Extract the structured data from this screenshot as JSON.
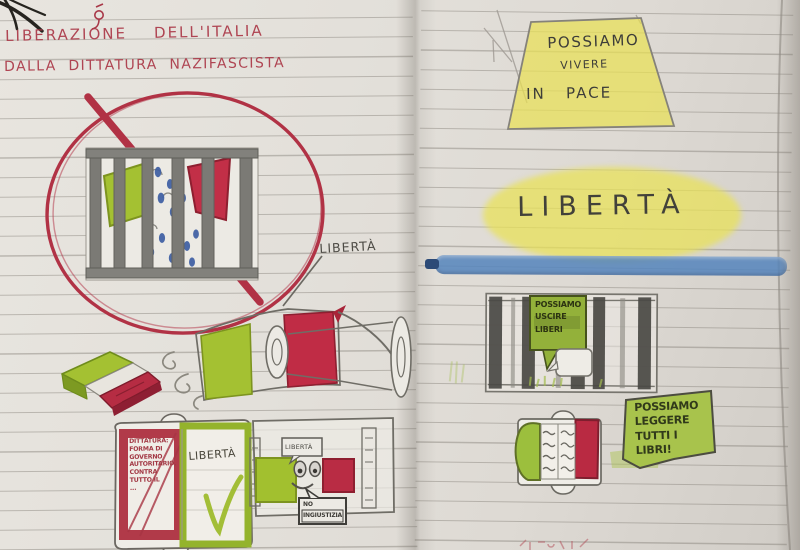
{
  "notebook": {
    "left_page": {
      "title_line1": "LIBERAZIONE    DELL'ITALIA",
      "title_line2": "DALLA  DITTATURA  NAZIFASCISTA",
      "liberta_caption": "LIBERTÀ",
      "definition_book": {
        "left_text": "DITTATURA:\nFORMA DI\nGOVERNO\nAUTORITARIO,\nCONTRA\nTUTTO IL\n...",
        "right_word": "LIBERTÀ"
      },
      "flag_character": {
        "bubble_top": "LIBERTÀ",
        "bubble_bottom": "NO\nINGIUSTIZIA"
      }
    },
    "right_page": {
      "peace_sign_line1": "POSSIAMO",
      "peace_sign_line2": "VIVERE",
      "peace_sign_line3": "IN   PACE",
      "liberta_word": "LIBERTÀ",
      "prison_bubble": "POSSIAMO\nUSCIRE\nLIBERI",
      "books_sign": "POSSIAMO\nLEGGERE\nTUTTI I\nLIBRI!"
    }
  },
  "colors": {
    "red_pen": "#b13245",
    "pencil_gray": "#6b6962",
    "flag_green": "#a4c132",
    "flag_red": "#c22f47",
    "highlight_yellow": "#e9e155",
    "crayon_blue": "#5585bd",
    "tear_blue": "#3e5fa3"
  }
}
